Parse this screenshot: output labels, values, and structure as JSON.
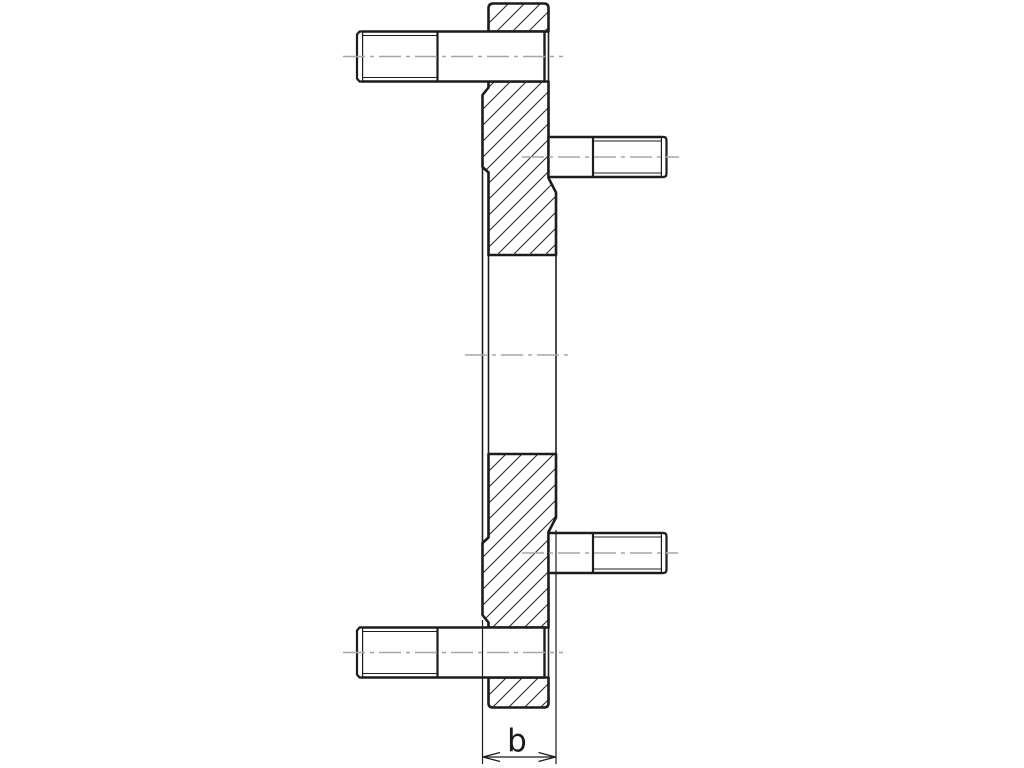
{
  "drawing": {
    "title": "flange-section-with-studs",
    "dimension_label": "b",
    "colors": {
      "line": "#1c1c1c",
      "centerline": "#a5a5a5",
      "background": "#ffffff",
      "hatch": "#2a2a2a"
    }
  }
}
